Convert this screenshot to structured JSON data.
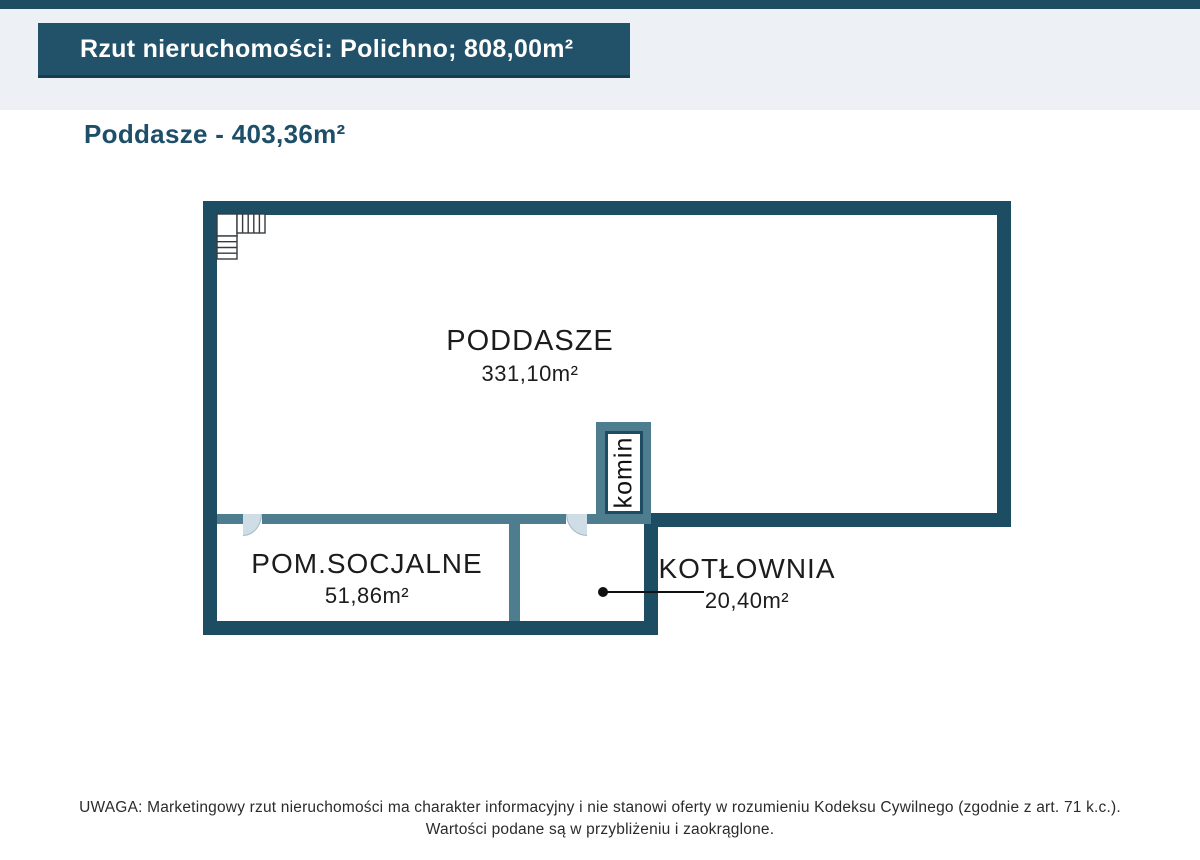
{
  "header": {
    "title": "Rzut nieruchomości: Polichno; 808,00m²",
    "subtitle": "Poddasze - 403,36m²"
  },
  "floorplan": {
    "rooms": [
      {
        "name": "PODDASZE",
        "area": "331,10m²"
      },
      {
        "name": "POM.SOCJALNE",
        "area": "51,86m²"
      },
      {
        "name": "KOTŁOWNIA",
        "area": "20,40m²"
      }
    ],
    "chimney_label": "komin"
  },
  "disclaimer": {
    "line1": "UWAGA: Marketingowy rzut nieruchomości ma charakter informacyjny i nie stanowi oferty w rozumieniu Kodeksu Cywilnego (zgodnie z art. 71 k.c.).",
    "line2": "Wartości podane są w przybliżeniu i zaokrąglone."
  },
  "colors": {
    "wall_dark": "#1d4d63",
    "wall_light": "#4e7d90",
    "header_box": "#22526a",
    "band_background": "#edf1f5",
    "door_fill": "#cfdde6"
  }
}
